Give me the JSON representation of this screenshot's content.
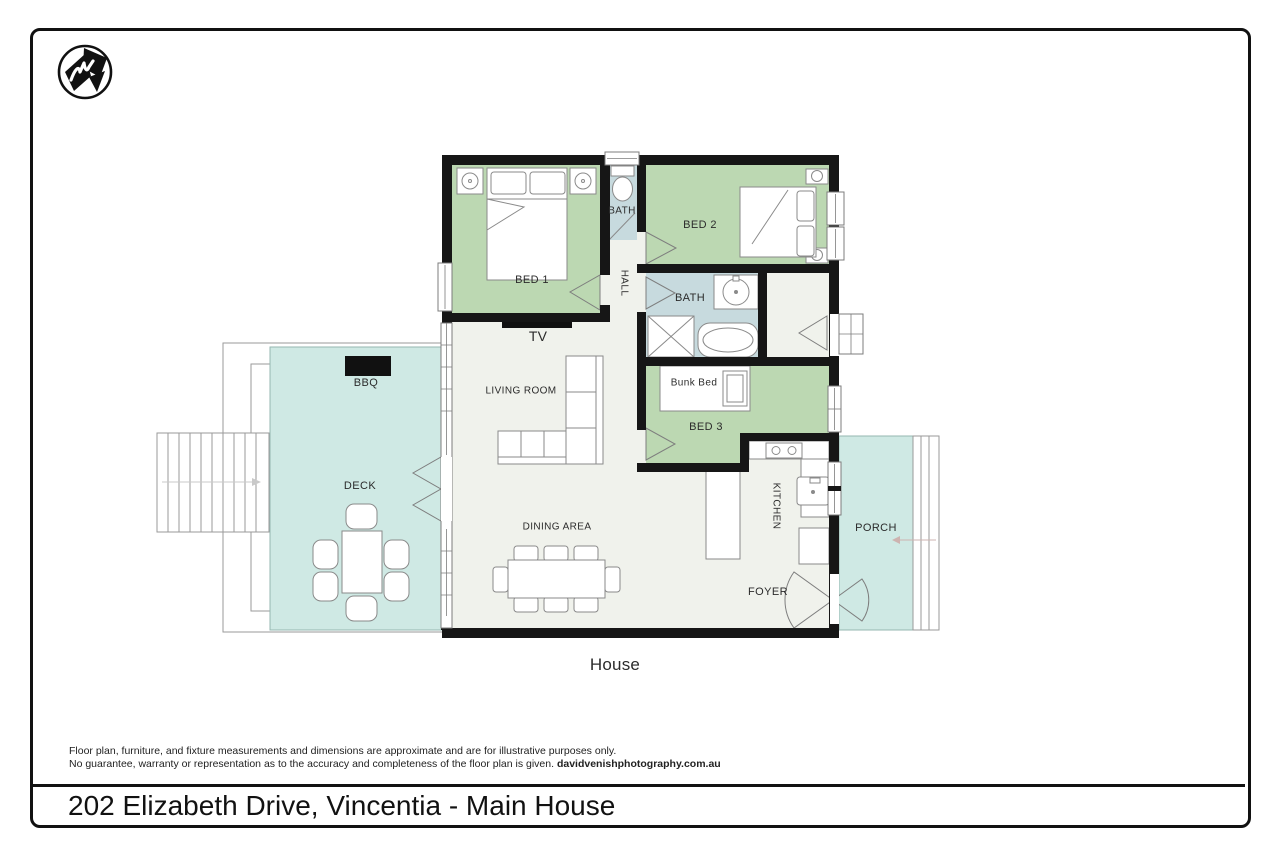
{
  "page": {
    "title": "202 Elizabeth Drive, Vincentia - Main House",
    "footnote_line1": "Floor plan, furniture, and fixture measurements and dimensions are approximate and are for illustrative purposes only.",
    "footnote_line2": "No guarantee, warranty or representation as to the accuracy and completeness of the floor plan is given.",
    "website": "davidvenishphotography.com.au"
  },
  "plan": {
    "house_label": "House",
    "rooms": {
      "bed1": "BED 1",
      "bath_top": "BATH",
      "hall": "HALL",
      "bed2": "BED 2",
      "bath_mid": "BATH",
      "bed3": "BED 3",
      "living_room": "LIVING ROOM",
      "dining_area": "DINING AREA",
      "kitchen": "KITCHEN",
      "foyer": "FOYER",
      "porch": "PORCH",
      "deck": "DECK"
    },
    "features": {
      "tv": "TV",
      "bbq": "BBQ",
      "bunk_bed": "Bunk Bed"
    }
  },
  "colors": {
    "bedroom_green": "#bcd8b2",
    "bath_blue": "#c7dade",
    "outdoor_teal": "#cfe9e4",
    "floor_light": "#f0f2ec",
    "wall_black": "#161616"
  }
}
